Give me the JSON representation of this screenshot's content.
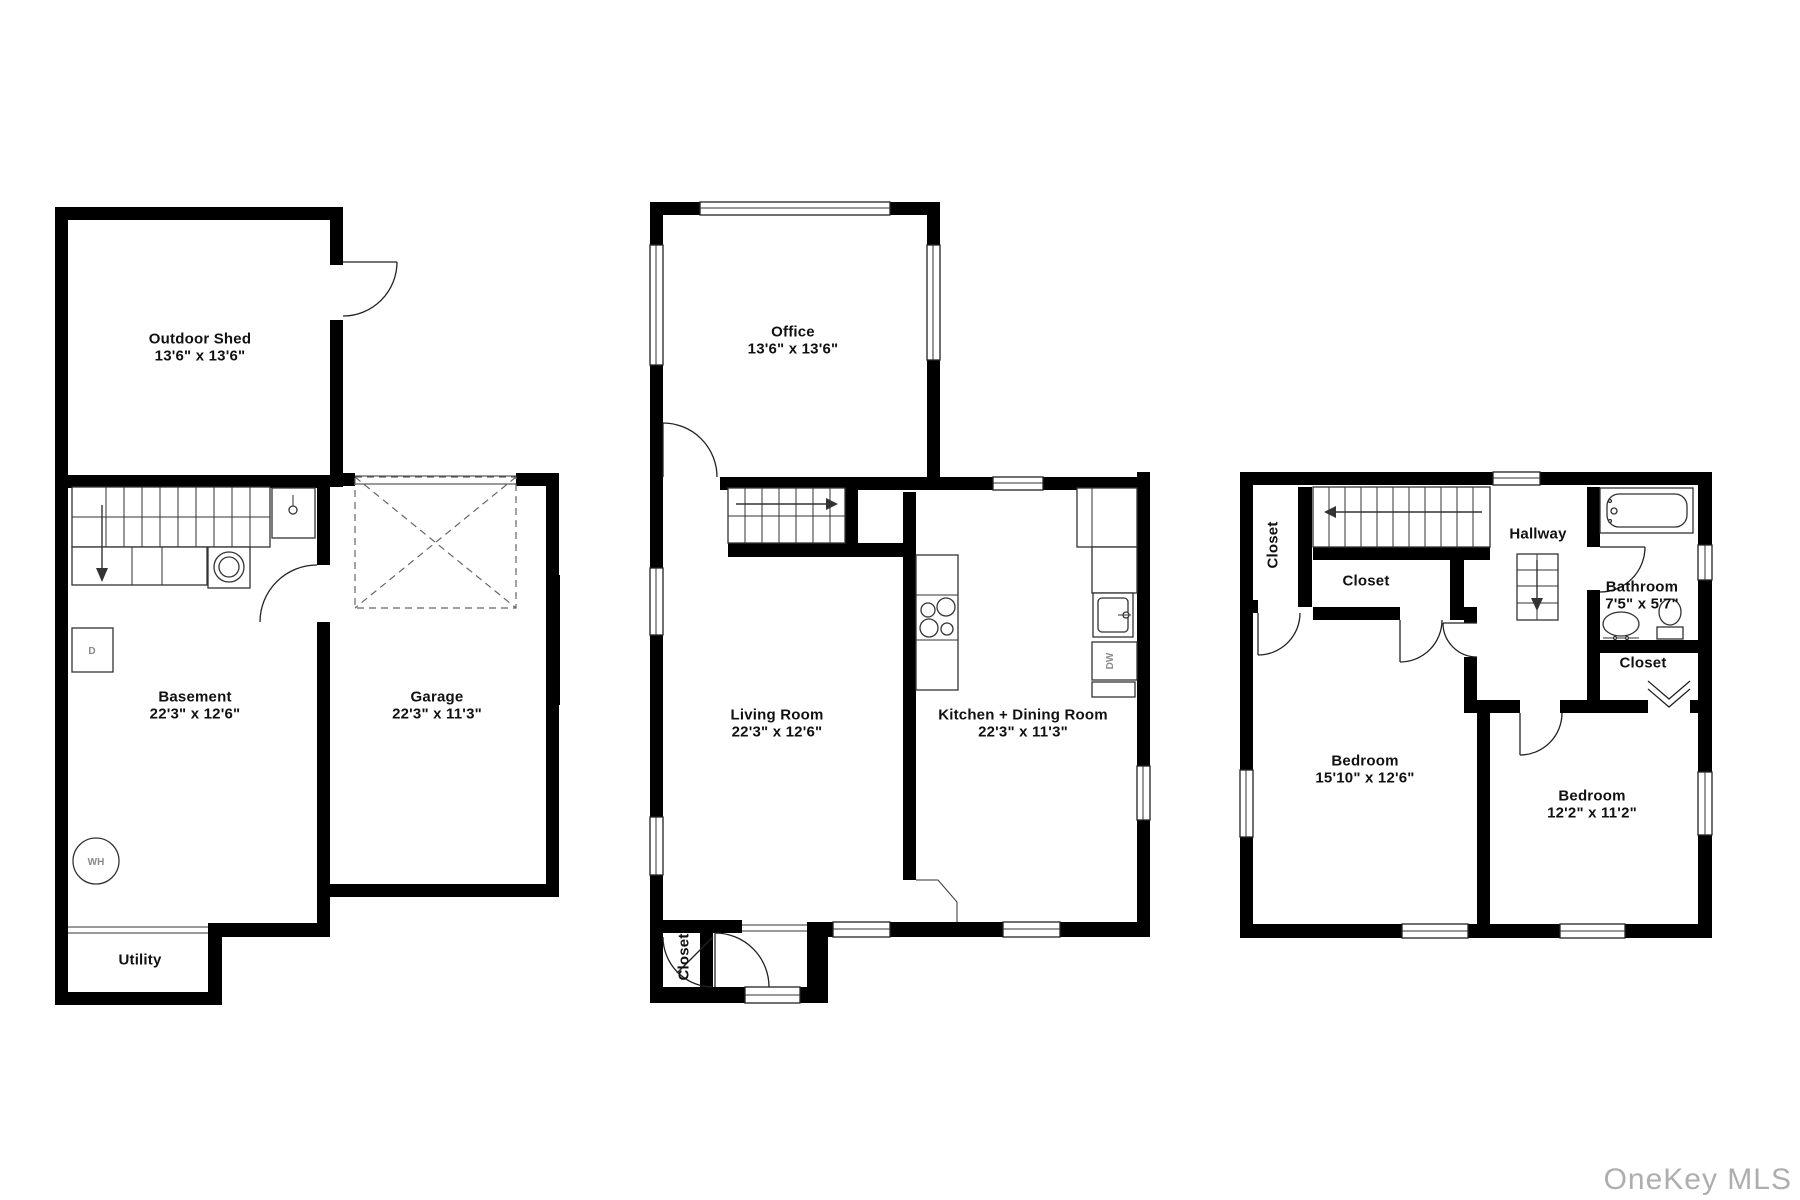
{
  "watermark": "OneKey MLS",
  "floors": {
    "basement": {
      "rooms": {
        "outdoor_shed": {
          "name": "Outdoor Shed",
          "dims": "13'6\" x 13'6\""
        },
        "basement": {
          "name": "Basement",
          "dims": "22'3\" x 12'6\""
        },
        "garage": {
          "name": "Garage",
          "dims": "22'3\" x 11'3\""
        },
        "utility": {
          "name": "Utility"
        }
      },
      "fixtures": {
        "water_heater": "WH",
        "dryer": "D"
      }
    },
    "first": {
      "rooms": {
        "office": {
          "name": "Office",
          "dims": "13'6\" x 13'6\""
        },
        "living_room": {
          "name": "Living Room",
          "dims": "22'3\" x 12'6\""
        },
        "kitchen_dining": {
          "name": "Kitchen + Dining Room",
          "dims": "22'3\" x 11'3\""
        },
        "entry_closet": {
          "name": "Closet"
        }
      },
      "fixtures": {
        "dishwasher": "DW"
      }
    },
    "second": {
      "rooms": {
        "closet_left": {
          "name": "Closet"
        },
        "closet_hall": {
          "name": "Closet"
        },
        "hallway": {
          "name": "Hallway"
        },
        "bathroom": {
          "name": "Bathroom",
          "dims": "7'5\" x 5'7\""
        },
        "closet_right": {
          "name": "Closet"
        },
        "bedroom_primary": {
          "name": "Bedroom",
          "dims": "15'10\" x 12'6\""
        },
        "bedroom_second": {
          "name": "Bedroom",
          "dims": "12'2\" x 11'2\""
        }
      }
    }
  }
}
